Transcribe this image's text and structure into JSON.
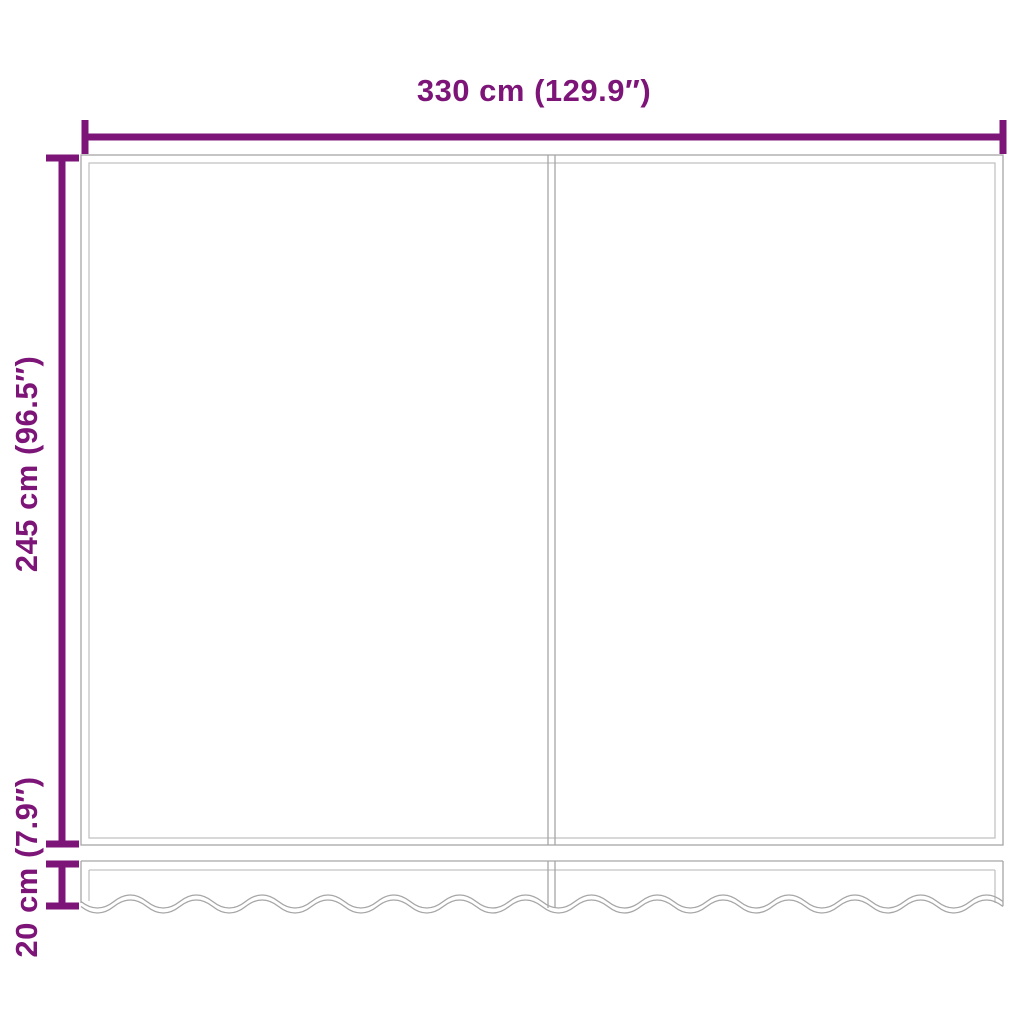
{
  "colors": {
    "dimension": "#7D1578",
    "outline": "#A6A6A6",
    "outline_inner": "#C4C4C4",
    "background": "#FFFFFF"
  },
  "labels": {
    "width": "330 cm (129.9″)",
    "height": "245 cm (96.5″)",
    "valance_height": "20 cm (7.9″)"
  }
}
